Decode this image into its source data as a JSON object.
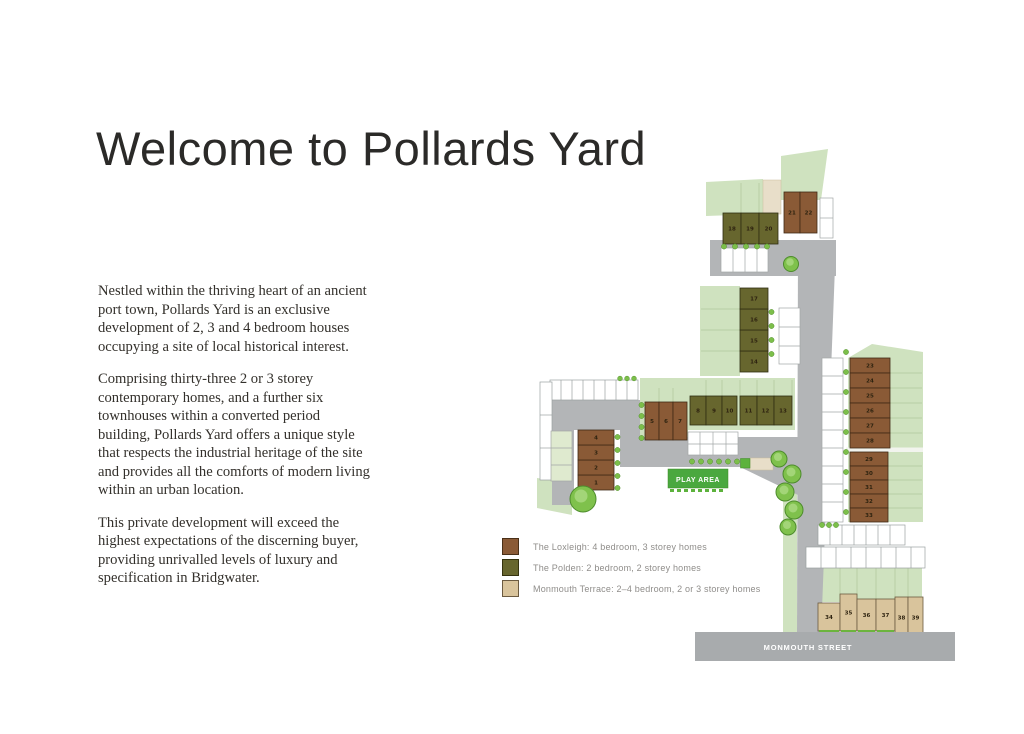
{
  "page": {
    "title": "Welcome to Pollards Yard"
  },
  "intro": {
    "paragraphs": [
      "Nestled within the thriving heart of an ancient port town, Pollards Yard is an exclusive development of 2, 3 and 4 bedroom houses occupying a site of local historical interest.",
      "Comprising thirty-three 2 or 3 storey contemporary homes, and a further six townhouses within a converted period building, Pollards Yard offers a unique style that respects the industrial heritage of the site and provides all the comforts of modern living within an urban location.",
      "This private development will exceed the highest expectations of the discerning buyer, providing unrivalled levels of luxury and specification in Bridgwater."
    ]
  },
  "legend": {
    "items": [
      {
        "name": "loxleigh",
        "label": "The Loxleigh: 4 bedroom, 3 storey homes",
        "color": "#8a5a36",
        "border": "#4a3018"
      },
      {
        "name": "polden",
        "label": "The Polden: 2 bedroom, 2 storey homes",
        "color": "#67662e",
        "border": "#35330f"
      },
      {
        "name": "monmouth",
        "label": "Monmouth Terrace: 2–4 bedroom, 2 or 3 storey homes",
        "color": "#d9c49c",
        "border": "#6b5a40"
      }
    ]
  },
  "site_plan": {
    "play_area_label": "PLAY AREA",
    "street_label": "MONMOUTH STREET",
    "colors": {
      "loxleigh": {
        "fill": "#8a5a36",
        "stroke": "#3f2a16"
      },
      "polden": {
        "fill": "#67662e",
        "stroke": "#2f2d12"
      },
      "monmouth": {
        "fill": "#d9c49c",
        "stroke": "#6b5a40"
      }
    },
    "plots": [
      {
        "n": 1,
        "type": "loxleigh",
        "x": 578,
        "y": 475,
        "w": 36,
        "h": 15
      },
      {
        "n": 2,
        "type": "loxleigh",
        "x": 578,
        "y": 460,
        "w": 36,
        "h": 15
      },
      {
        "n": 3,
        "type": "loxleigh",
        "x": 578,
        "y": 445,
        "w": 36,
        "h": 15
      },
      {
        "n": 4,
        "type": "loxleigh",
        "x": 578,
        "y": 430,
        "w": 36,
        "h": 15
      },
      {
        "n": 5,
        "type": "loxleigh",
        "x": 645,
        "y": 402,
        "w": 14,
        "h": 38
      },
      {
        "n": 6,
        "type": "loxleigh",
        "x": 659,
        "y": 402,
        "w": 14,
        "h": 38
      },
      {
        "n": 7,
        "type": "loxleigh",
        "x": 673,
        "y": 402,
        "w": 14,
        "h": 38
      },
      {
        "n": 8,
        "type": "polden",
        "x": 690,
        "y": 396,
        "w": 16,
        "h": 29
      },
      {
        "n": 9,
        "type": "polden",
        "x": 706,
        "y": 396,
        "w": 16,
        "h": 29
      },
      {
        "n": 10,
        "type": "polden",
        "x": 722,
        "y": 396,
        "w": 15,
        "h": 29
      },
      {
        "n": 11,
        "type": "polden",
        "x": 740,
        "y": 396,
        "w": 17,
        "h": 29
      },
      {
        "n": 12,
        "type": "polden",
        "x": 757,
        "y": 396,
        "w": 17,
        "h": 29
      },
      {
        "n": 13,
        "type": "polden",
        "x": 774,
        "y": 396,
        "w": 18,
        "h": 29
      },
      {
        "n": 14,
        "type": "polden",
        "x": 740,
        "y": 351,
        "w": 28,
        "h": 21
      },
      {
        "n": 15,
        "type": "polden",
        "x": 740,
        "y": 330,
        "w": 28,
        "h": 21
      },
      {
        "n": 16,
        "type": "polden",
        "x": 740,
        "y": 309,
        "w": 28,
        "h": 21
      },
      {
        "n": 17,
        "type": "polden",
        "x": 740,
        "y": 288,
        "w": 28,
        "h": 21
      },
      {
        "n": 18,
        "type": "polden",
        "x": 723,
        "y": 213,
        "w": 18,
        "h": 31
      },
      {
        "n": 19,
        "type": "polden",
        "x": 741,
        "y": 213,
        "w": 18,
        "h": 31
      },
      {
        "n": 20,
        "type": "polden",
        "x": 759,
        "y": 213,
        "w": 19,
        "h": 31
      },
      {
        "n": 21,
        "type": "loxleigh",
        "x": 784,
        "y": 192,
        "w": 16,
        "h": 41
      },
      {
        "n": 22,
        "type": "loxleigh",
        "x": 800,
        "y": 192,
        "w": 17,
        "h": 41
      },
      {
        "n": 23,
        "type": "loxleigh",
        "x": 850,
        "y": 358,
        "w": 40,
        "h": 15
      },
      {
        "n": 24,
        "type": "loxleigh",
        "x": 850,
        "y": 373,
        "w": 40,
        "h": 15
      },
      {
        "n": 25,
        "type": "loxleigh",
        "x": 850,
        "y": 388,
        "w": 40,
        "h": 15
      },
      {
        "n": 26,
        "type": "loxleigh",
        "x": 850,
        "y": 403,
        "w": 40,
        "h": 15
      },
      {
        "n": 27,
        "type": "loxleigh",
        "x": 850,
        "y": 418,
        "w": 40,
        "h": 15
      },
      {
        "n": 28,
        "type": "loxleigh",
        "x": 850,
        "y": 433,
        "w": 40,
        "h": 15
      },
      {
        "n": 29,
        "type": "loxleigh",
        "x": 850,
        "y": 452,
        "w": 38,
        "h": 14
      },
      {
        "n": 30,
        "type": "loxleigh",
        "x": 850,
        "y": 466,
        "w": 38,
        "h": 14
      },
      {
        "n": 31,
        "type": "loxleigh",
        "x": 850,
        "y": 480,
        "w": 38,
        "h": 14
      },
      {
        "n": 32,
        "type": "loxleigh",
        "x": 850,
        "y": 494,
        "w": 38,
        "h": 14
      },
      {
        "n": 33,
        "type": "loxleigh",
        "x": 850,
        "y": 508,
        "w": 38,
        "h": 14
      },
      {
        "n": 34,
        "type": "monmouth",
        "x": 818,
        "y": 603,
        "w": 22,
        "h": 28
      },
      {
        "n": 35,
        "type": "monmouth",
        "x": 840,
        "y": 594,
        "w": 17,
        "h": 37
      },
      {
        "n": 36,
        "type": "monmouth",
        "x": 857,
        "y": 599,
        "w": 19,
        "h": 32
      },
      {
        "n": 37,
        "type": "monmouth",
        "x": 876,
        "y": 599,
        "w": 19,
        "h": 32
      },
      {
        "n": 38,
        "type": "monmouth",
        "x": 895,
        "y": 597,
        "w": 13,
        "h": 41
      },
      {
        "n": 39,
        "type": "monmouth",
        "x": 908,
        "y": 597,
        "w": 15,
        "h": 41
      }
    ]
  }
}
